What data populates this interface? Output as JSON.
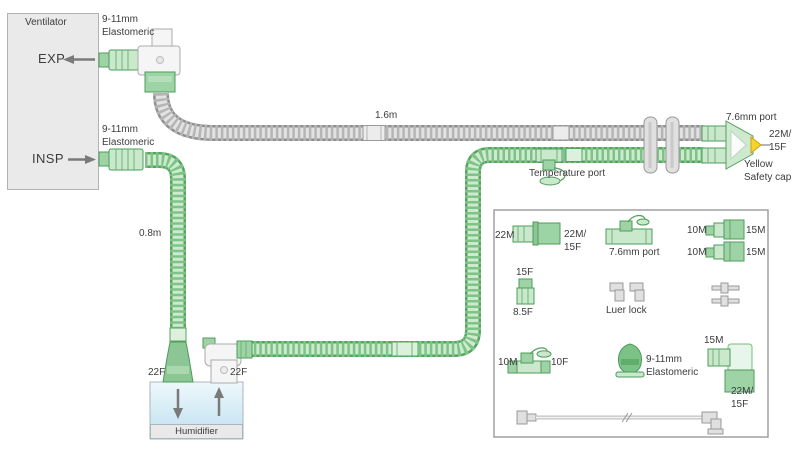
{
  "ventilator": {
    "label": "Ventilator",
    "exp": "EXP",
    "insp": "INSP"
  },
  "circuit": {
    "exp_elastomeric": "9-11mm\nElastomeric",
    "insp_elastomeric": "9-11mm\nElastomeric",
    "exp_limb_length": "1.6m",
    "insp_limb_length": "0.8m",
    "port_76": "7.6mm port",
    "patient_connector": "22M/\n15F",
    "safety_cap": "Yellow\nSafety cap",
    "temperature_port": "Temperature port",
    "humidifier": {
      "label": "Humidifier",
      "inlet": "22F",
      "outlet": "22F"
    }
  },
  "legend": {
    "straight_22m": "22M",
    "straight_22m15f": "22M/\n15F",
    "tee_76_port": "7.6mm port",
    "adapter1_10m": "10M",
    "adapter1_15m": "15M",
    "adapter2_10m": "10M",
    "adapter2_15m": "15M",
    "conn_15f": "15F",
    "conn_85f": "8.5F",
    "luer_lock": "Luer lock",
    "tee_10m": "10M",
    "tee_10f": "10F",
    "elastomeric": "9-11mm\nElastomeric",
    "elbow_15m": "15M",
    "elbow_22m15f": "22M/\n15F"
  },
  "colors": {
    "circuit_green": "#6cb576",
    "tube_gray": "#b5b5b5",
    "safety_cap_yellow": "#f5d42c",
    "humidifier_water": "#bfe0ef",
    "ventilator_box": "#eaeaea"
  }
}
